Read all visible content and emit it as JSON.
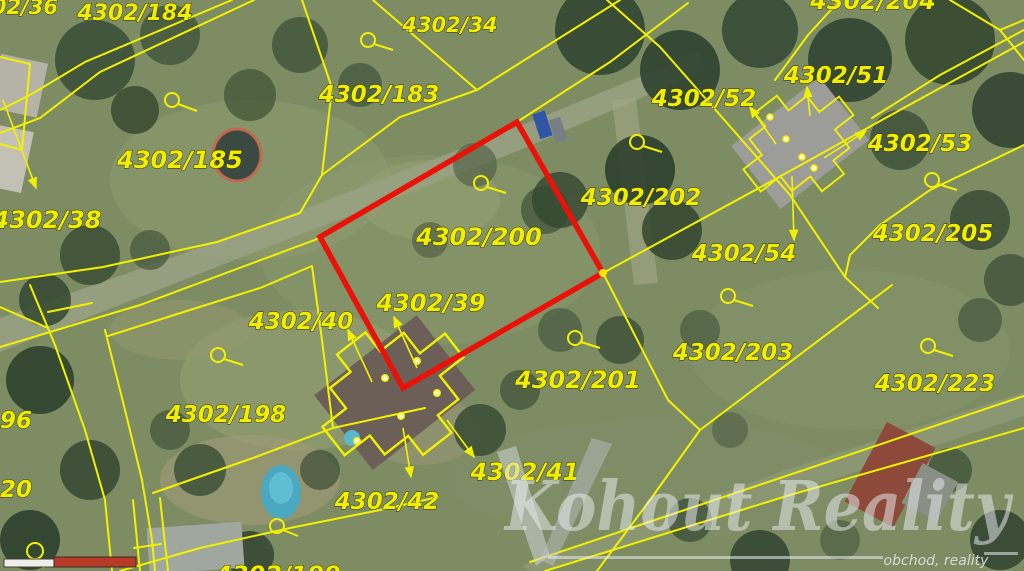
{
  "title": "Cadastral map with highlighted parcel 4302/200",
  "labels": [
    "4302/36",
    "4302/184",
    "4302/34",
    "4302/183",
    "4302/51",
    "4302/52",
    "4302/53",
    "4302/185",
    "4302/205",
    "4302/38",
    "4302/202",
    "4302/200",
    "4302/54",
    "4302/39",
    "4302/40",
    "4302/203",
    "4302/223",
    "4302/201",
    "4302/198",
    "96",
    "20",
    "4302/41",
    "4302/42",
    "4302/199",
    "4302/204"
  ],
  "highlight": {
    "parcel_number": "4302/200",
    "outline_color": "#ea1208"
  },
  "boundary_color": "#f2f200",
  "label_color": "#f2ee00",
  "watermark": {
    "brand": "Kohout Reality",
    "tagline": "obchod, reality"
  },
  "icons": {
    "landuse_symbol": "circle-tail-icon",
    "direction_arrow": "arrow-icon",
    "boundary_point": "dot-icon",
    "scale_bar": "scale-bar"
  }
}
